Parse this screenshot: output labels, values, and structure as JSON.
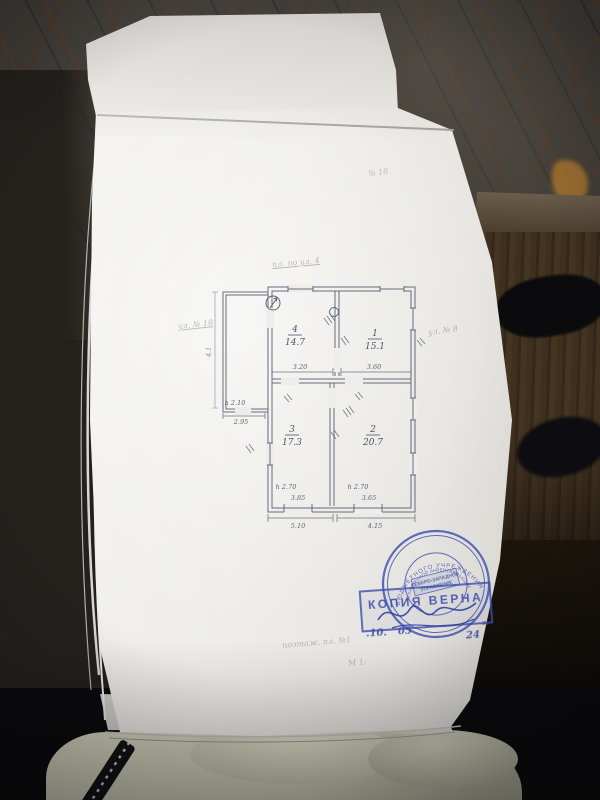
{
  "scene": {
    "description": "Photograph of a paper floor-plan document lying against dark patterned wallpaper, dark furniture at right, beige quilted jacket at bottom",
    "colors": {
      "wallpaper_base": "#544f48",
      "wallpaper_lattice": "#7a4826",
      "paper": "#f2f1ee",
      "plan_ink": "#596274",
      "stamp_blue": "#3d4fae",
      "wood": "#3a2d1e",
      "jacket": "#d9d8c2"
    }
  },
  "plan": {
    "rooms": [
      {
        "number": "4",
        "area": "14.7"
      },
      {
        "number": "1",
        "area": "15.1"
      },
      {
        "number": "3",
        "area": "17.3"
      },
      {
        "number": "2",
        "area": "20.7"
      }
    ],
    "dimensions": {
      "mid_left": "3.20",
      "mid_right": "3.60",
      "inner_bottom_left": "3.85",
      "inner_bottom_right": "3.65",
      "bottom_left": "5.10",
      "bottom_right": "4.15",
      "annex_height": "h 2.10",
      "annex_width": "2.95",
      "room_height_left": "h 2.70",
      "room_height_right": "h 2.70",
      "side_left": "4.1"
    }
  },
  "stamps": {
    "copy": {
      "title": "КОПИЯ ВЕРНА",
      "day": ".10.",
      "month": "05",
      "year": "24",
      "year_suffix": "г."
    },
    "seal": {
      "ring_outer": "БЮДЖЕТНОГО УЧРЕЖДЕНИЯ",
      "ring_inner": "ТЕХНИЧЕСКОЙ ИНВЕНТАРИЗАЦИИ",
      "center_line1": "СЕВЕРО-ЗАПАДНОЕ",
      "center_line2": "УПРАВЛЕНИЕ"
    }
  },
  "annotations": {
    "top_right": "№ 18",
    "above_plan": "пл. по ул. 4",
    "left": "ул. № 18",
    "right": "ул. № 8",
    "bottom_line1": "поэтаж. пл. №1",
    "bottom_line2": "М 1:"
  }
}
